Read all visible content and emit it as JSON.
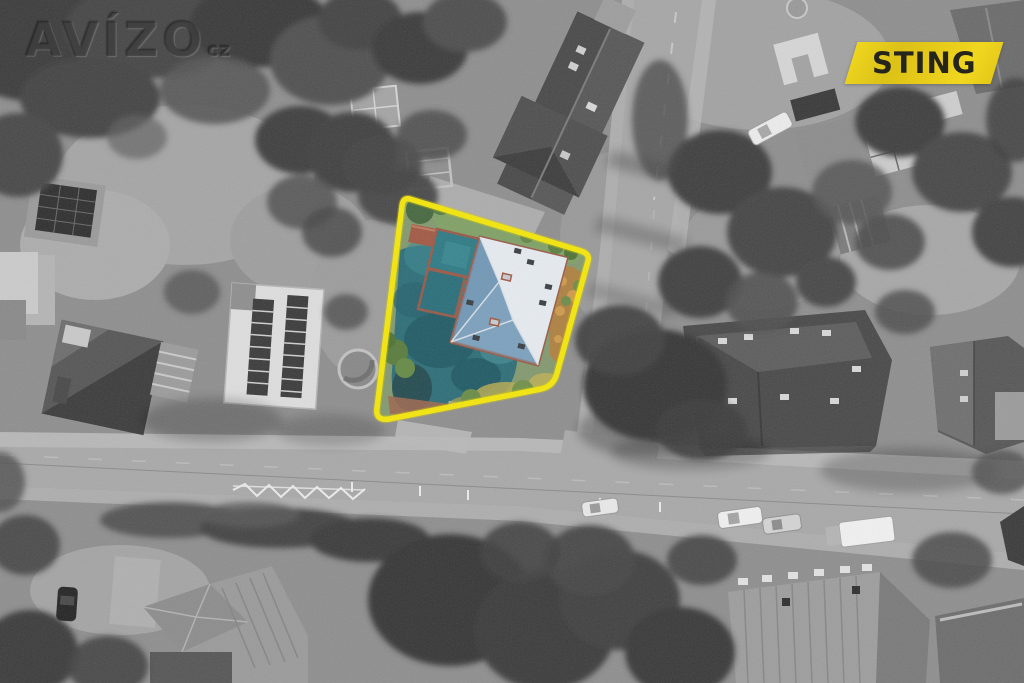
{
  "image": {
    "description": "Black-and-white aerial photograph of a residential street block; one property is shown in colour and outlined with a yellow boundary",
    "style": "real-estate listing aerial photo"
  },
  "watermark": {
    "text": "AVÍZO",
    "suffix": "cz"
  },
  "agency_badge": {
    "label": "STING",
    "background_color": "#e3c81c",
    "text_color": "#25251d"
  },
  "highlight": {
    "boundary_color": "#f4e60b",
    "property_roof_color": "#7ca0bd",
    "property_courtyard_color": "#2e6e78",
    "property_garden_color": "#b07f3f"
  }
}
